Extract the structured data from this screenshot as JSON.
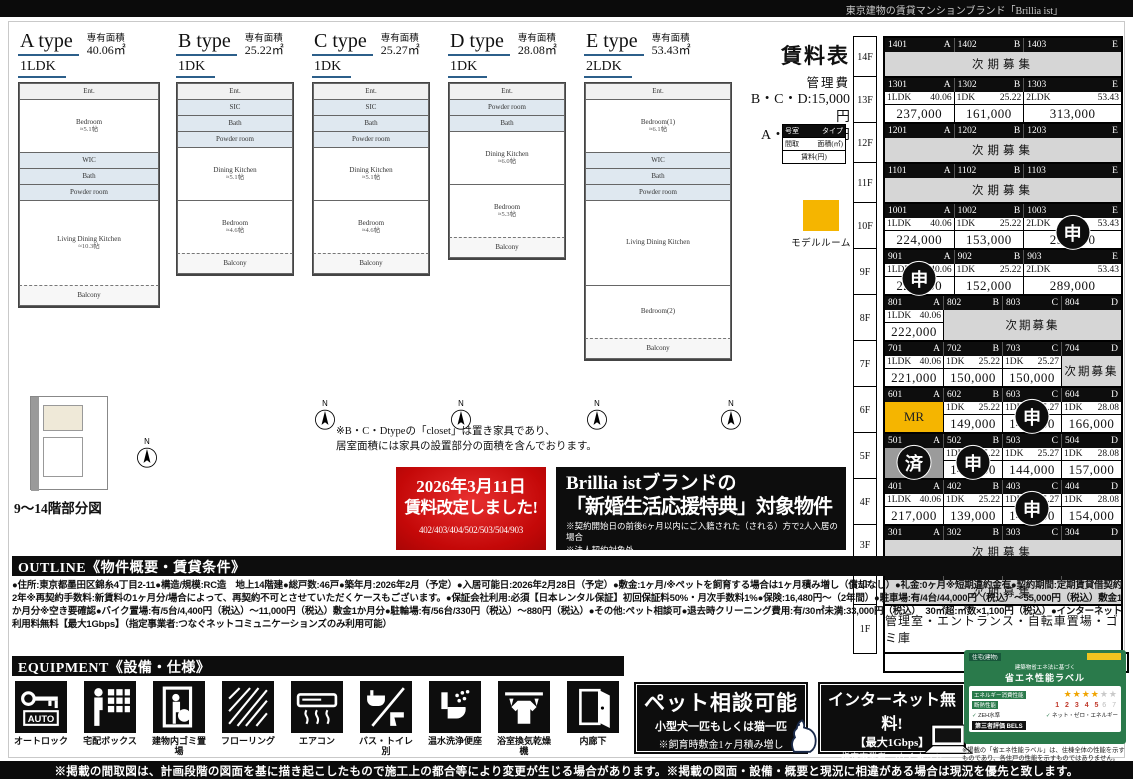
{
  "top_bar": {
    "text": "東京建物の賃貸マンションブランド「Brillia ist」"
  },
  "bottom_bar": {
    "text": "※掲載の間取図は、計画段階の図面を基に描き起こしたもので施工上の都合等により変更が生じる場合があります。※掲載の図面・設備・概要と現況に相違がある場合は現況を優先と致します。"
  },
  "floorplans": {
    "area_label": "専有面積",
    "compass_label": "N",
    "closet_note_line1": "※B・C・Dtypeの「closet」は置き家具であり、",
    "closet_note_line2": "居室面積には家具の設置部分の面積を含んでおります。",
    "partial_plan_label": "9～14階部分図",
    "types": [
      {
        "name": "A type",
        "plan": "1LDK",
        "area": "40.06㎡",
        "rooms": [
          {
            "k": "small",
            "n": "Ent."
          },
          {
            "k": "room",
            "n": "Bedroom",
            "s": "≈5.1帖"
          },
          {
            "k": "wet",
            "n": "WIC"
          },
          {
            "k": "wet",
            "n": "Bath"
          },
          {
            "k": "wet",
            "n": "Powder room"
          },
          {
            "k": "big",
            "n": "Living Dining Kitchen",
            "s": "≈10.3帖"
          },
          {
            "k": "balcony",
            "n": "Balcony"
          }
        ]
      },
      {
        "name": "B type",
        "plan": "1DK",
        "area": "25.22㎡",
        "rooms": [
          {
            "k": "small",
            "n": "Ent."
          },
          {
            "k": "wet",
            "n": "SIC"
          },
          {
            "k": "wet",
            "n": "Bath"
          },
          {
            "k": "wet",
            "n": "Powder room"
          },
          {
            "k": "room",
            "n": "Dining Kitchen",
            "s": "≈5.1帖"
          },
          {
            "k": "room",
            "n": "Bedroom",
            "s": "≈4.6帖"
          },
          {
            "k": "balcony",
            "n": "Balcony"
          }
        ]
      },
      {
        "name": "C type",
        "plan": "1DK",
        "area": "25.27㎡",
        "rooms": [
          {
            "k": "small",
            "n": "Ent."
          },
          {
            "k": "wet",
            "n": "SIC"
          },
          {
            "k": "wet",
            "n": "Bath"
          },
          {
            "k": "wet",
            "n": "Powder room"
          },
          {
            "k": "room",
            "n": "Dining Kitchen",
            "s": "≈5.1帖"
          },
          {
            "k": "room",
            "n": "Bedroom",
            "s": "≈4.6帖"
          },
          {
            "k": "balcony",
            "n": "Balcony"
          }
        ]
      },
      {
        "name": "D type",
        "plan": "1DK",
        "area": "28.08㎡",
        "rooms": [
          {
            "k": "small",
            "n": "Ent."
          },
          {
            "k": "wet",
            "n": "Powder room"
          },
          {
            "k": "wet",
            "n": "Bath"
          },
          {
            "k": "room",
            "n": "Dining Kitchen",
            "s": "≈6.0帖"
          },
          {
            "k": "room",
            "n": "Bedroom",
            "s": "≈5.3帖"
          },
          {
            "k": "balcony",
            "n": "Balcony"
          }
        ]
      },
      {
        "name": "E type",
        "plan": "2LDK",
        "area": "53.43㎡",
        "rooms": [
          {
            "k": "small",
            "n": "Ent."
          },
          {
            "k": "room",
            "n": "Bedroom(1)",
            "s": "≈6.1帖"
          },
          {
            "k": "wet",
            "n": "WIC"
          },
          {
            "k": "wet",
            "n": "Bath"
          },
          {
            "k": "wet",
            "n": "Powder room"
          },
          {
            "k": "big",
            "n": "Living Dining Kitchen"
          },
          {
            "k": "room",
            "n": "Bedroom(2)"
          },
          {
            "k": "balcony",
            "n": "Balcony"
          }
        ]
      }
    ]
  },
  "rate_revision_box": {
    "line1": "2026年3月11日",
    "line2": "賃料改定しました!",
    "rooms": "402/403/404/502/503/504/903"
  },
  "campaign_box": {
    "line1": "Brillia istブランドの",
    "line2": "「新婚生活応援特典」対象物件",
    "note1": "※契約開始日の前後6ヶ月以内にご入籍された（される）方で2人入居の場合",
    "note2": "※法人契約対象外"
  },
  "rent_table": {
    "title": "賃料表",
    "mgmt_label": "管理費",
    "fee1": "B・C・D:15,000円",
    "fee2": "A・E:20,000円",
    "legend": {
      "room_label": "号室",
      "type_label": "タイプ",
      "plan_label": "間取",
      "area_label": "面積(㎡)",
      "rent_label": "賃料(円)"
    },
    "model_room_label": "モデルルーム",
    "next_label": "次期募集",
    "south_label": "南",
    "floors": [
      {
        "floor": "14F",
        "cols": [
          0.295,
          0.295,
          0.41
        ],
        "header": [
          {
            "no": "1401",
            "type": "A"
          },
          {
            "no": "1402",
            "type": "B"
          },
          {
            "no": "1403",
            "type": "E"
          }
        ],
        "cells": [
          {
            "kind": "next",
            "span": 3
          }
        ]
      },
      {
        "floor": "13F",
        "cols": [
          0.295,
          0.295,
          0.41
        ],
        "header": [
          {
            "no": "1301",
            "type": "A"
          },
          {
            "no": "1302",
            "type": "B"
          },
          {
            "no": "1303",
            "type": "E"
          }
        ],
        "cells": [
          {
            "kind": "unit",
            "span": 1,
            "plan": "1LDK",
            "area": "40.06",
            "rent": "237,000"
          },
          {
            "kind": "unit",
            "span": 1,
            "plan": "1DK",
            "area": "25.22",
            "rent": "161,000"
          },
          {
            "kind": "unit",
            "span": 1,
            "plan": "2LDK",
            "area": "53.43",
            "rent": "313,000"
          }
        ]
      },
      {
        "floor": "12F",
        "cols": [
          0.295,
          0.295,
          0.41
        ],
        "header": [
          {
            "no": "1201",
            "type": "A"
          },
          {
            "no": "1202",
            "type": "B"
          },
          {
            "no": "1203",
            "type": "E"
          }
        ],
        "cells": [
          {
            "kind": "next",
            "span": 3
          }
        ]
      },
      {
        "floor": "11F",
        "cols": [
          0.295,
          0.295,
          0.41
        ],
        "header": [
          {
            "no": "1101",
            "type": "A"
          },
          {
            "no": "1102",
            "type": "B"
          },
          {
            "no": "1103",
            "type": "E"
          }
        ],
        "cells": [
          {
            "kind": "next",
            "span": 3
          }
        ]
      },
      {
        "floor": "10F",
        "cols": [
          0.295,
          0.295,
          0.41
        ],
        "header": [
          {
            "no": "1001",
            "type": "A"
          },
          {
            "no": "1002",
            "type": "B"
          },
          {
            "no": "1003",
            "type": "E"
          }
        ],
        "cells": [
          {
            "kind": "unit",
            "span": 1,
            "plan": "1LDK",
            "area": "40.06",
            "rent": "224,000"
          },
          {
            "kind": "unit",
            "span": 1,
            "plan": "1DK",
            "area": "25.22",
            "rent": "153,000"
          },
          {
            "kind": "unit",
            "span": 1,
            "plan": "2LDK",
            "area": "53.43",
            "rent": "290,000",
            "badge": "申"
          }
        ]
      },
      {
        "floor": "9F",
        "cols": [
          0.295,
          0.295,
          0.41
        ],
        "header": [
          {
            "no": "901",
            "type": "A"
          },
          {
            "no": "902",
            "type": "B"
          },
          {
            "no": "903",
            "type": "E"
          }
        ],
        "cells": [
          {
            "kind": "unit",
            "span": 1,
            "plan": "1LDK",
            "area": "40.06",
            "rent": "223,000",
            "badge": "申"
          },
          {
            "kind": "unit",
            "span": 1,
            "plan": "1DK",
            "area": "25.22",
            "rent": "152,000"
          },
          {
            "kind": "unit",
            "span": 1,
            "plan": "2LDK",
            "area": "53.43",
            "rent": "289,000"
          }
        ]
      },
      {
        "floor": "8F",
        "cols": [
          0.25,
          0.25,
          0.25,
          0.25
        ],
        "header": [
          {
            "no": "801",
            "type": "A"
          },
          {
            "no": "802",
            "type": "B"
          },
          {
            "no": "803",
            "type": "C"
          },
          {
            "no": "804",
            "type": "D"
          }
        ],
        "cells": [
          {
            "kind": "unit",
            "span": 1,
            "plan": "1LDK",
            "area": "40.06",
            "rent": "222,000"
          },
          {
            "kind": "next",
            "span": 3
          }
        ]
      },
      {
        "floor": "7F",
        "cols": [
          0.25,
          0.25,
          0.25,
          0.25
        ],
        "header": [
          {
            "no": "701",
            "type": "A"
          },
          {
            "no": "702",
            "type": "B"
          },
          {
            "no": "703",
            "type": "C"
          },
          {
            "no": "704",
            "type": "D"
          }
        ],
        "cells": [
          {
            "kind": "unit",
            "span": 1,
            "plan": "1LDK",
            "area": "40.06",
            "rent": "221,000"
          },
          {
            "kind": "unit",
            "span": 1,
            "plan": "1DK",
            "area": "25.22",
            "rent": "150,000"
          },
          {
            "kind": "unit",
            "span": 1,
            "plan": "1DK",
            "area": "25.27",
            "rent": "150,000"
          },
          {
            "kind": "next",
            "span": 1
          }
        ]
      },
      {
        "floor": "6F",
        "cols": [
          0.25,
          0.25,
          0.25,
          0.25
        ],
        "header": [
          {
            "no": "601",
            "type": "A"
          },
          {
            "no": "602",
            "type": "B"
          },
          {
            "no": "603",
            "type": "C"
          },
          {
            "no": "604",
            "type": "D"
          }
        ],
        "cells": [
          {
            "kind": "mr",
            "span": 1,
            "label": "MR"
          },
          {
            "kind": "unit",
            "span": 1,
            "plan": "1DK",
            "area": "25.22",
            "rent": "149,000"
          },
          {
            "kind": "unit",
            "span": 1,
            "plan": "1DK",
            "area": "25.27",
            "rent": "147,000",
            "badge": "申"
          },
          {
            "kind": "unit",
            "span": 1,
            "plan": "1DK",
            "area": "28.08",
            "rent": "166,000"
          }
        ]
      },
      {
        "floor": "5F",
        "cols": [
          0.25,
          0.25,
          0.25,
          0.25
        ],
        "header": [
          {
            "no": "501",
            "type": "A"
          },
          {
            "no": "502",
            "type": "B"
          },
          {
            "no": "503",
            "type": "C"
          },
          {
            "no": "504",
            "type": "D"
          }
        ],
        "cells": [
          {
            "kind": "leased",
            "span": 1,
            "badge": "済"
          },
          {
            "kind": "unit",
            "span": 1,
            "plan": "1DK",
            "area": "25.22",
            "rent": "144,000",
            "badge": "申"
          },
          {
            "kind": "unit",
            "span": 1,
            "plan": "1DK",
            "area": "25.27",
            "rent": "144,000"
          },
          {
            "kind": "unit",
            "span": 1,
            "plan": "1DK",
            "area": "28.08",
            "rent": "157,000"
          }
        ]
      },
      {
        "floor": "4F",
        "cols": [
          0.25,
          0.25,
          0.25,
          0.25
        ],
        "header": [
          {
            "no": "401",
            "type": "A"
          },
          {
            "no": "402",
            "type": "B"
          },
          {
            "no": "403",
            "type": "C"
          },
          {
            "no": "404",
            "type": "D"
          }
        ],
        "cells": [
          {
            "kind": "unit",
            "span": 1,
            "plan": "1LDK",
            "area": "40.06",
            "rent": "217,000"
          },
          {
            "kind": "unit",
            "span": 1,
            "plan": "1DK",
            "area": "25.22",
            "rent": "139,000"
          },
          {
            "kind": "unit",
            "span": 1,
            "plan": "1DK",
            "area": "25.27",
            "rent": "141,000",
            "badge": "申"
          },
          {
            "kind": "unit",
            "span": 1,
            "plan": "1DK",
            "area": "28.08",
            "rent": "154,000"
          }
        ]
      },
      {
        "floor": "3F",
        "cols": [
          0.25,
          0.25,
          0.25,
          0.25
        ],
        "header": [
          {
            "no": "301",
            "type": "A"
          },
          {
            "no": "302",
            "type": "B"
          },
          {
            "no": "303",
            "type": "C"
          },
          {
            "no": "304",
            "type": "D"
          }
        ],
        "cells": [
          {
            "kind": "next",
            "span": 4
          }
        ]
      },
      {
        "floor": "2F",
        "cols": [
          0.25,
          0.25,
          0.25,
          0.25
        ],
        "header": [
          {
            "no": "201",
            "type": "A"
          },
          {
            "no": "202",
            "type": "B"
          },
          {
            "no": "203",
            "type": "C"
          },
          {
            "no": "204",
            "type": "D"
          }
        ],
        "cells": [
          {
            "kind": "next",
            "span": 4
          }
        ]
      },
      {
        "floor": "1F",
        "cols": [
          1
        ],
        "header": null,
        "cells": [
          {
            "kind": "text",
            "span": 1,
            "label": "管理室・エントランス・自転車置場・ゴミ庫"
          }
        ]
      }
    ]
  },
  "outline": {
    "header": "OUTLINE《物件概要・賃貸条件》",
    "body": "●住所:東京都墨田区錦糸4丁目2-11●構造/規模:RC造　地上14階建●総戸数:46戸●築年月:2026年2月（予定）●入居可能日:2026年2月28日（予定）●敷金:1ヶ月/※ペットを飼育する場合は1ヶ月積み増し（償却なし）●礼金:0ヶ月※短期違約金有●契約期間:定期賃貸借契約2年※再契約手数料:新賃料の1ヶ月分/場合によって、再契約不可とさせていただくケースもございます。●保証会社利用:必須【日本レンタル保証】初回保証料50%・月次手数料1%●保険:16,480円～（2年間）●駐車場:有/4台/44,000円（税込）～55,000円（税込）敷金1か月分※空き要確認●バイク置場:有/5台/4,400円（税込）～11,000円（税込）敷金1か月分●駐輪場:有/56台/330円（税込）～880円（税込）●その他:ペット相談可●退去時クリーニング費用:有/30㎡未満:33,000円（税込）　30㎡超:㎡数×1,100円（税込）●インターネット利用料無料【最大1Gbps】（指定事業者:つなぐネットコミュニケーションズのみ利用可能）"
  },
  "equipment": {
    "header": "EQUIPMENT《設備・仕様》",
    "items": [
      {
        "label": "オートロック",
        "icon": "autolock-icon",
        "auto_text": "AUTO"
      },
      {
        "label": "宅配ボックス",
        "icon": "delivery-box-icon"
      },
      {
        "label": "建物内ゴミ置場",
        "icon": "garbage-room-icon"
      },
      {
        "label": "フローリング",
        "icon": "flooring-icon"
      },
      {
        "label": "エアコン",
        "icon": "air-conditioner-icon"
      },
      {
        "label": "バス・トイレ別",
        "icon": "separate-bath-toilet-icon"
      },
      {
        "label": "温水洗浄便座",
        "icon": "washlet-icon"
      },
      {
        "label": "浴室換気乾燥機",
        "icon": "bathroom-dryer-icon"
      },
      {
        "label": "内廊下",
        "icon": "inner-corridor-icon"
      }
    ]
  },
  "pet_box": {
    "title": "ペット相談可能",
    "line2": "小型犬一匹もしくは猫一匹",
    "line3": "※飼育時敷金1ヶ月積み増し"
  },
  "internet_box": {
    "title": "インターネット無料!",
    "line2": "【最大1Gbps】",
    "line3": "指定事業者:つなぐネット",
    "line4": "コミュニケーションズのみ利用可"
  },
  "energy_label": {
    "title_small": "建築物省エネ法に基づく",
    "title": "省エネ性能ラベル",
    "row1": "エネルギー消費性能",
    "stars_on": "★★★★",
    "stars_off": "★★",
    "row2": "断熱性能",
    "scale_on": "1 2 3 4 5",
    "scale_off": "6 7",
    "check_mark": "✓",
    "check1": "ZEH水準",
    "check2": "ネット・ゼロ・エネルギー",
    "bels": "第三者評価 BELS",
    "chip1": "住宅(建物)",
    "caption": "※掲載の「省エネ性能ラベル」は、住棟全体の性能を示すものであり、各住戸の性能を示すものではありません。"
  },
  "colors": {
    "accent_yellow": "#f5b500",
    "table_gray": "#d6d6d6",
    "leased_gray": "#9b9b9b",
    "underline_blue": "#2c5f8a",
    "red_box": "#c40808",
    "energy_green": "#2a7a4b"
  }
}
